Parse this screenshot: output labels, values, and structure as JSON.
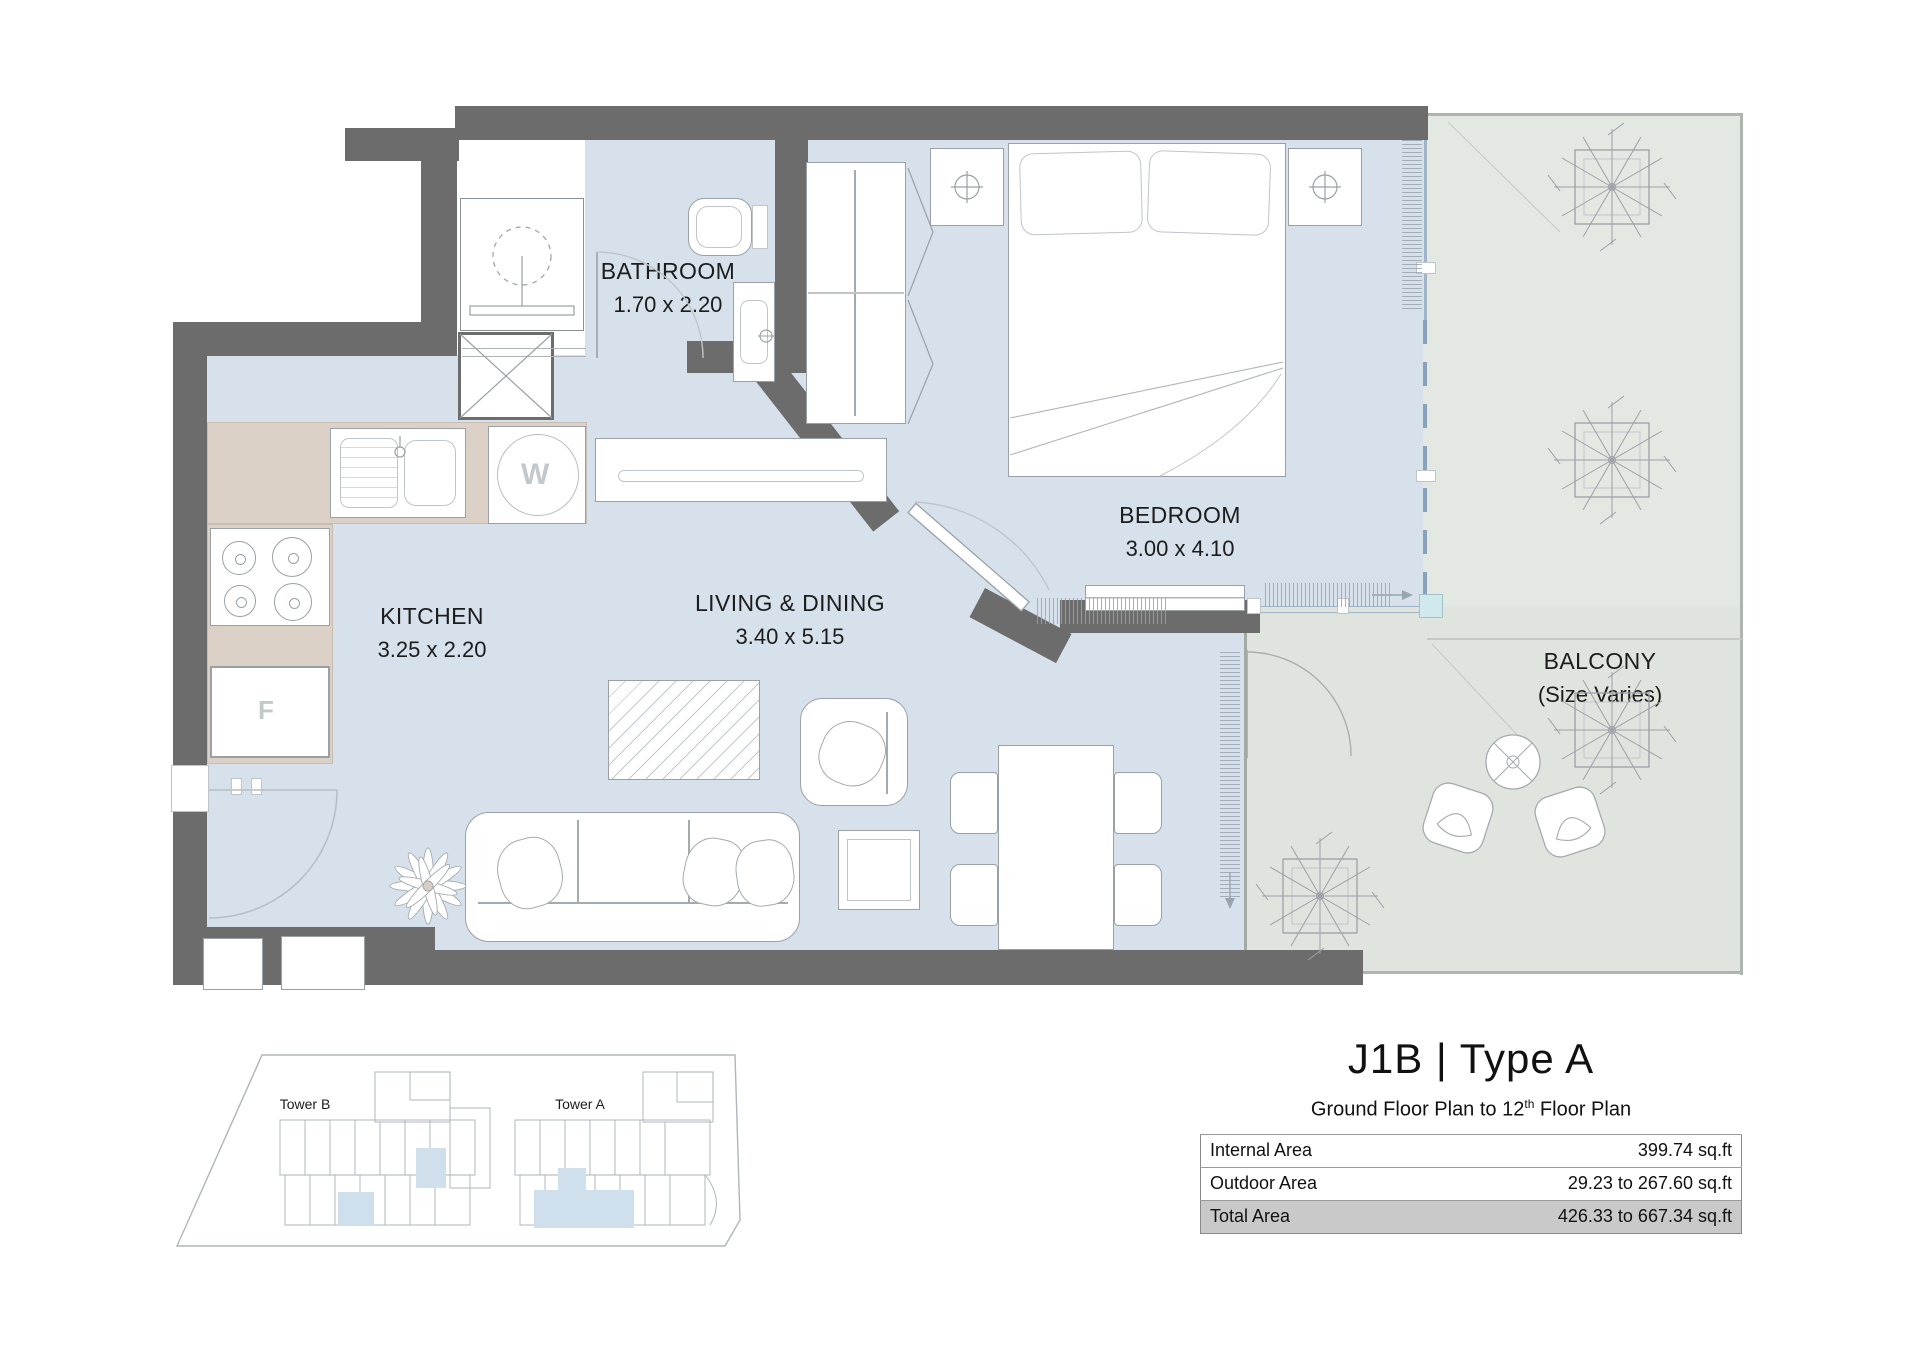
{
  "colors": {
    "wall": "#6c6c6c",
    "floor_interior": "#d6e1ec",
    "floor_balcony_upper": "#e4e8e2",
    "floor_balcony_lower": "#e0e4de",
    "kitchen_counter": "#dcd1c6",
    "site_highlight": "#cfe0ec",
    "total_row": "#c9c9c9"
  },
  "plan": {
    "rooms": {
      "bathroom": {
        "name": "BATHROOM",
        "dims": "1.70 x 2.20"
      },
      "kitchen": {
        "name": "KITCHEN",
        "dims": "3.25 x 2.20"
      },
      "living": {
        "name": "LIVING & DINING",
        "dims": "3.40 x 5.15"
      },
      "bedroom": {
        "name": "BEDROOM",
        "dims": "3.00 x 4.10"
      },
      "balcony": {
        "name": "BALCONY",
        "dims": "(Size Varies)"
      }
    },
    "appliances": {
      "washer": "W",
      "fridge": "F"
    }
  },
  "site_plan": {
    "tower_b": "Tower B",
    "tower_a": "Tower A"
  },
  "title_block": {
    "title": "J1B | Type A",
    "subtitle": {
      "prefix": "Ground Floor Plan to 12",
      "sup": "th",
      "suffix": " Floor Plan"
    },
    "table": {
      "rows": [
        {
          "label": "Internal Area",
          "value": "399.74 sq.ft"
        },
        {
          "label": "Outdoor Area",
          "value": "29.23 to 267.60 sq.ft"
        },
        {
          "label": "Total Area",
          "value": "426.33 to 667.34 sq.ft"
        }
      ]
    }
  }
}
